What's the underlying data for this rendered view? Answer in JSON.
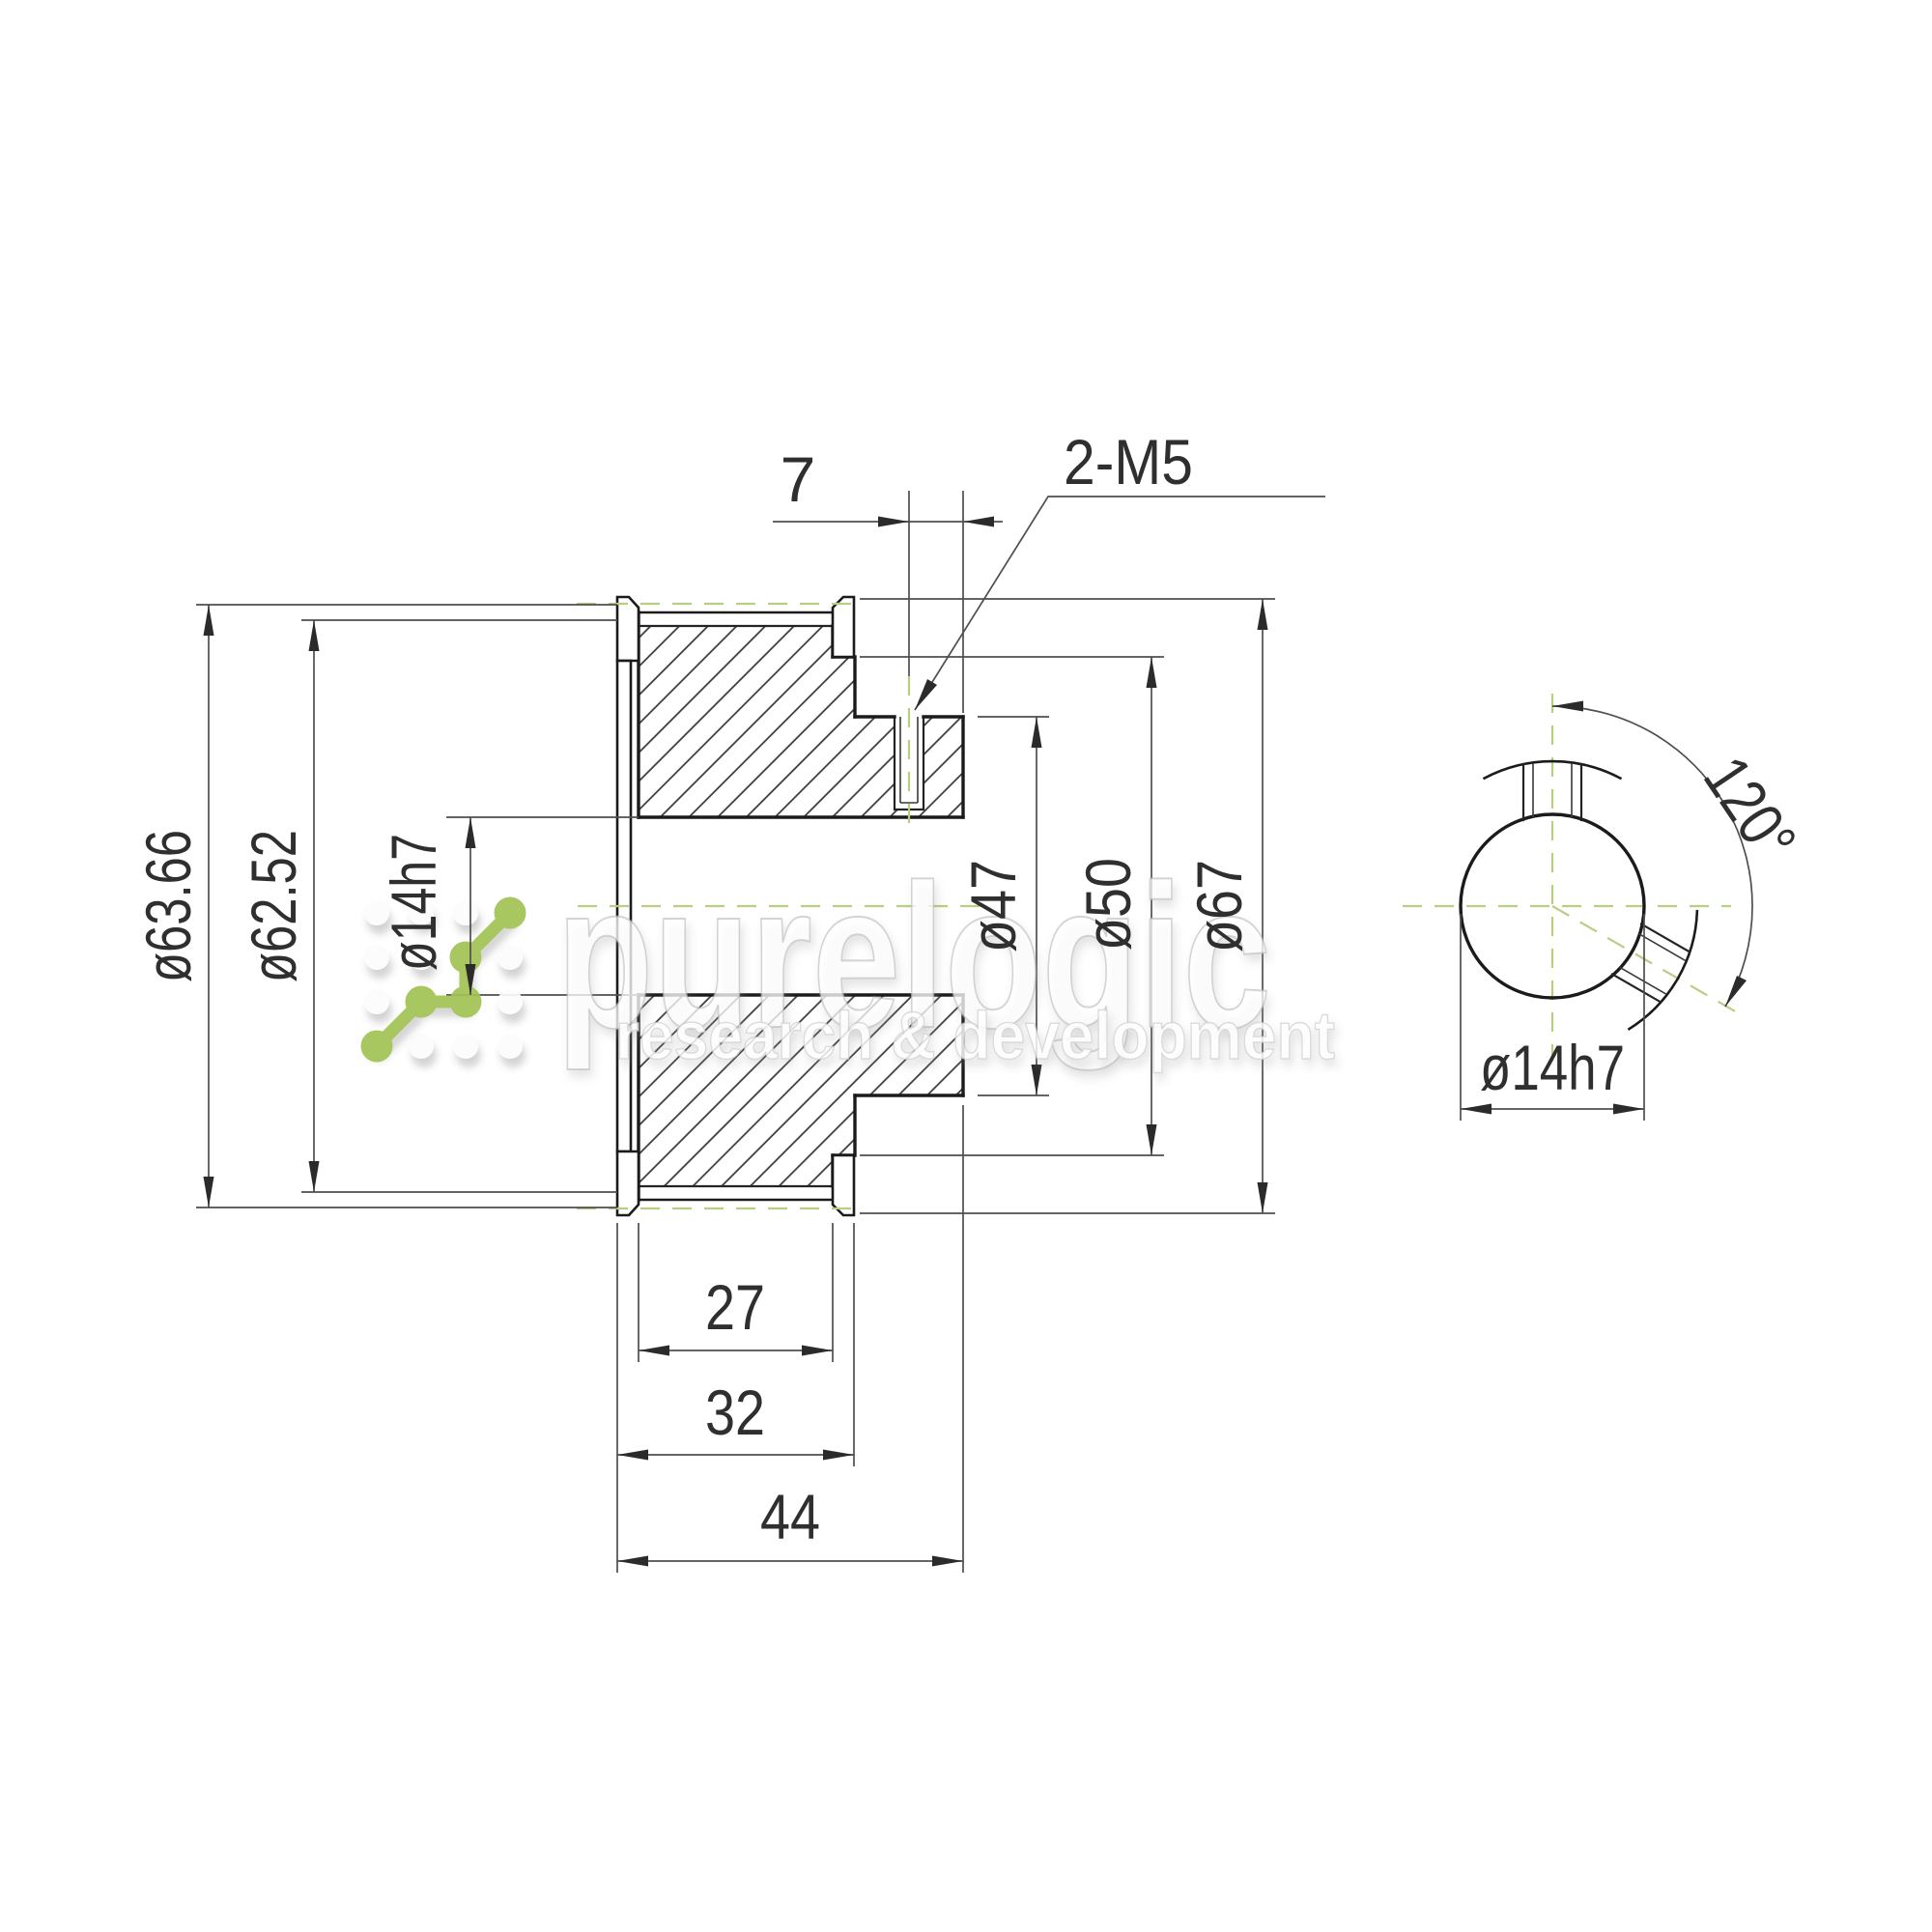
{
  "drawing": {
    "dimensions": {
      "pitch_diameter": "ø63.66",
      "tooth_outer_diameter": "ø62.52",
      "bore": "ø14h7",
      "hub_diameter": "ø47",
      "flange_seat_diameter": "ø50",
      "flange_diameter": "ø67",
      "setscrew_offset": "7",
      "setscrew_thread": "2-M5",
      "belt_width": "27",
      "width_over_flanges": "32",
      "overall_length": "44",
      "setscrew_angle": "120°",
      "bore_end_view": "ø14h7"
    },
    "colors": {
      "accent_green": "#a3c355",
      "centerline_green": "#b7cf80",
      "line_dark": "#1b1b1b"
    }
  },
  "watermark": {
    "brand": "purelogic",
    "tagline": "research & development"
  }
}
